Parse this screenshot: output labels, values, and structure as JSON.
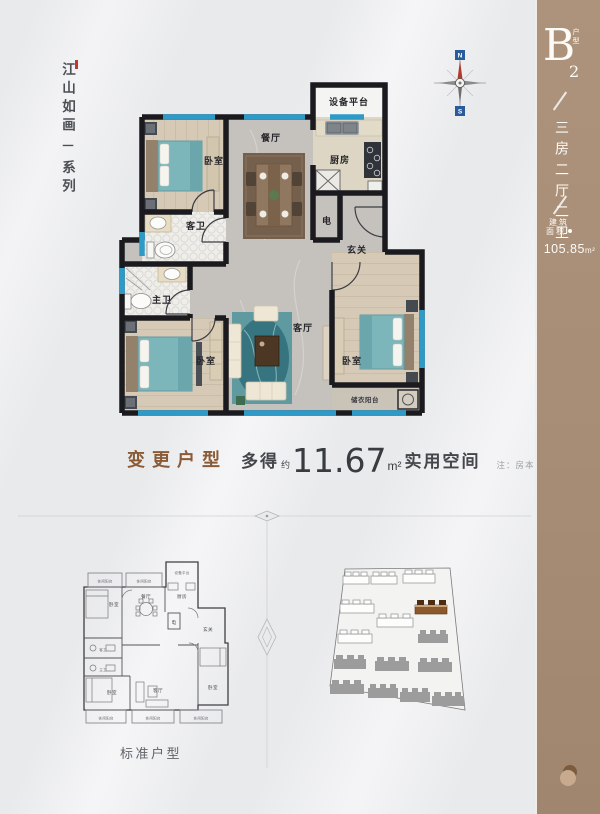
{
  "poster": {
    "series_tagline": {
      "main": "江山如画",
      "dash": "一",
      "sub": "系列"
    },
    "unit_badge": {
      "letter": "B",
      "number": "2",
      "caption": "户型"
    },
    "unit_layout": "三房二厅二卫",
    "area": {
      "caption_line1": "建筑",
      "caption_line2": "面积",
      "value": "105.85",
      "unit": "m²"
    },
    "compass": {
      "north": "N",
      "south": "S"
    },
    "main_plan_rooms": {
      "equipment": "设备平台",
      "kitchen": "厨房",
      "dining": "餐厅",
      "bedroom_top": "卧室",
      "guest_bath": "客卫",
      "elec": "电",
      "entry": "玄关",
      "master_bath": "主卫",
      "bedroom_left": "卧室",
      "living": "客厅",
      "bedroom_right": "卧室",
      "storage_balcony": "储衣阳台"
    },
    "headline": {
      "label": "变更户型",
      "gain_prefix": "多得",
      "approx": "约",
      "value": "11.67",
      "unit": "m²",
      "gain_suffix": "实用空间",
      "note": "注：房本面积不变"
    },
    "standard_plan": {
      "caption": "标准户型",
      "rooms": {
        "balcony_top_left": "休闲阳台",
        "balcony_top_mid": "休闲阳台",
        "equipment": "设备平台",
        "kitchen": "厨房",
        "bedroom_top": "卧室",
        "dining": "餐厅",
        "elec": "电",
        "entry": "玄关",
        "guest_bath": "客卫",
        "master_bath": "主卫",
        "bedroom_left": "卧室",
        "living": "客厅",
        "bedroom_right": "卧室",
        "balcony_bottom_left": "休闲阳台",
        "balcony_bottom_mid": "休闲阳台",
        "balcony_bottom_right": "休闲阳台"
      }
    }
  }
}
